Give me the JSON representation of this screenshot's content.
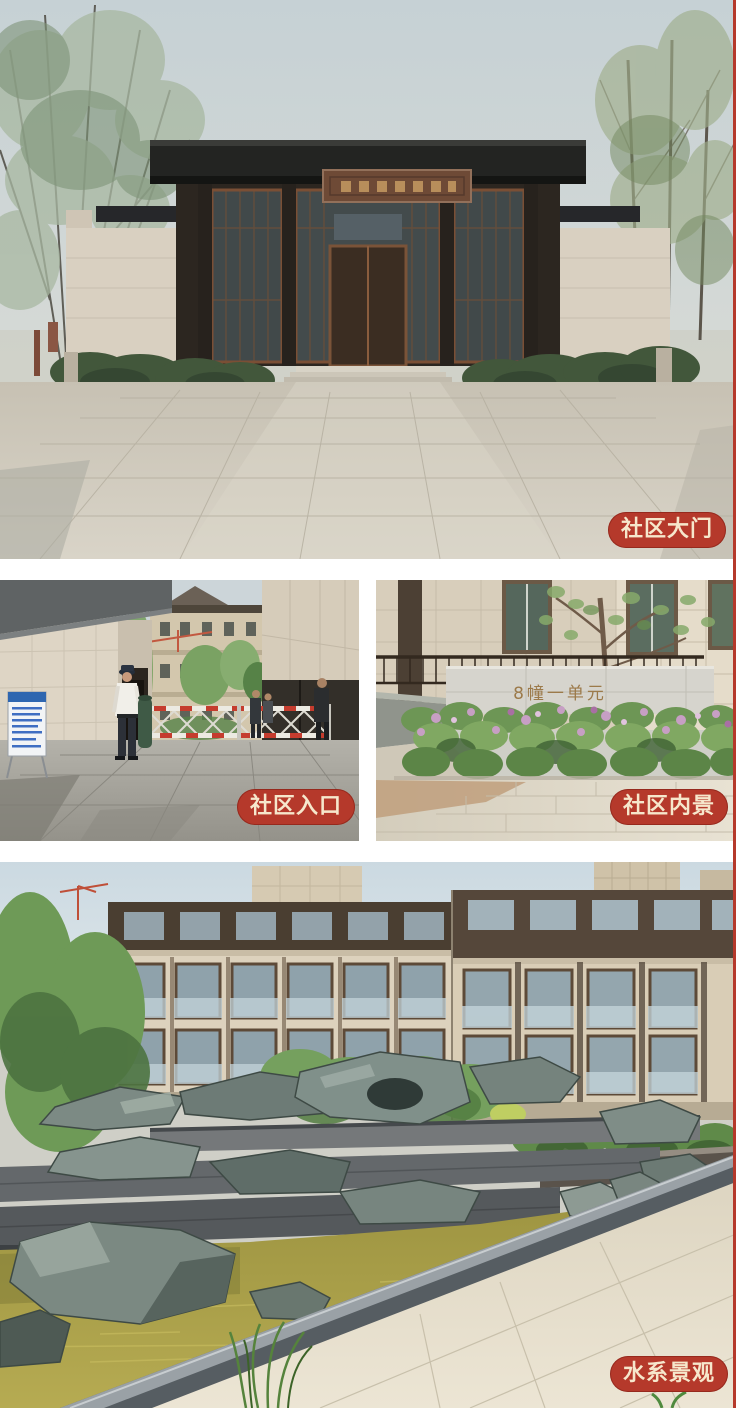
{
  "page": {
    "background": "#ffffff",
    "right_accent_strip_color": "#b5392b"
  },
  "badge_style": {
    "background": "#b5392b",
    "text_color": "#f6e7cc"
  },
  "photos": {
    "gate": {
      "label": "社区大门"
    },
    "entrance": {
      "label": "社区入口"
    },
    "interior": {
      "label": "社区内景",
      "wall_sign_text": "8幢一单元"
    },
    "water": {
      "label": "水系景观"
    }
  },
  "palette": {
    "sky": "#c9d3d6",
    "stone_wall": "#d8cfc0",
    "dark_roof": "#232422",
    "wood_frame": "#6e4a36",
    "plaza_pavement": "#cdc7ba",
    "foliage": "#7e9d68",
    "barrier_red": "#c53c2e",
    "pond_water": "#a89e4a",
    "rockery_grey": "#7b8982",
    "walkway": "#e2dac6"
  }
}
